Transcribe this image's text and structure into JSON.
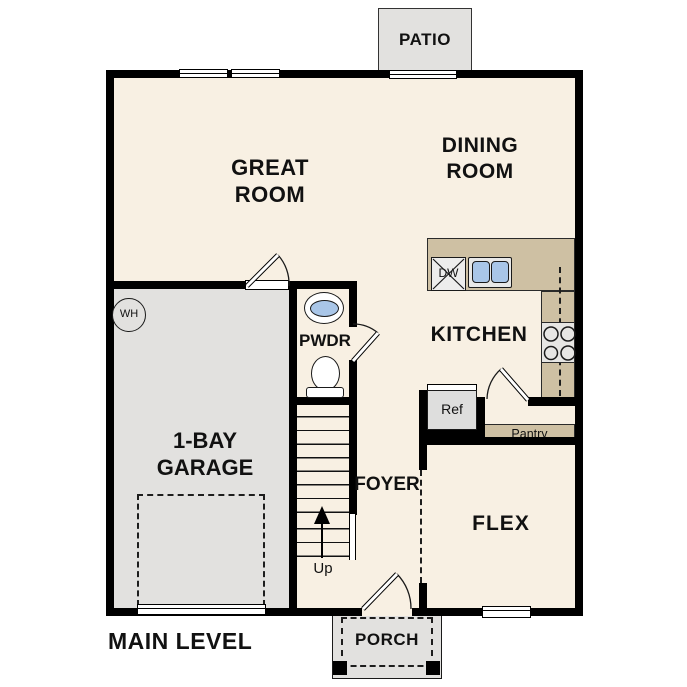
{
  "plan": {
    "level_label": "MAIN LEVEL",
    "rooms": {
      "great_room": "GREAT ROOM",
      "dining_room": "DINING ROOM",
      "kitchen": "KITCHEN",
      "powder_room": "PWDR",
      "foyer": "FOYER",
      "flex": "FLEX",
      "garage": "1-BAY GARAGE",
      "patio": "PATIO",
      "porch": "PORCH"
    },
    "fixtures": {
      "water_heater": "WH",
      "dishwasher": "DW",
      "refrigerator": "Ref",
      "pantry": "Pantry",
      "stairs_direction": "Up"
    },
    "colors": {
      "floor": "#f8f0e3",
      "concrete": "#e2e1df",
      "counter": "#cec0a3",
      "sink_blue": "#a9c6e8",
      "wall": "#000000"
    }
  }
}
